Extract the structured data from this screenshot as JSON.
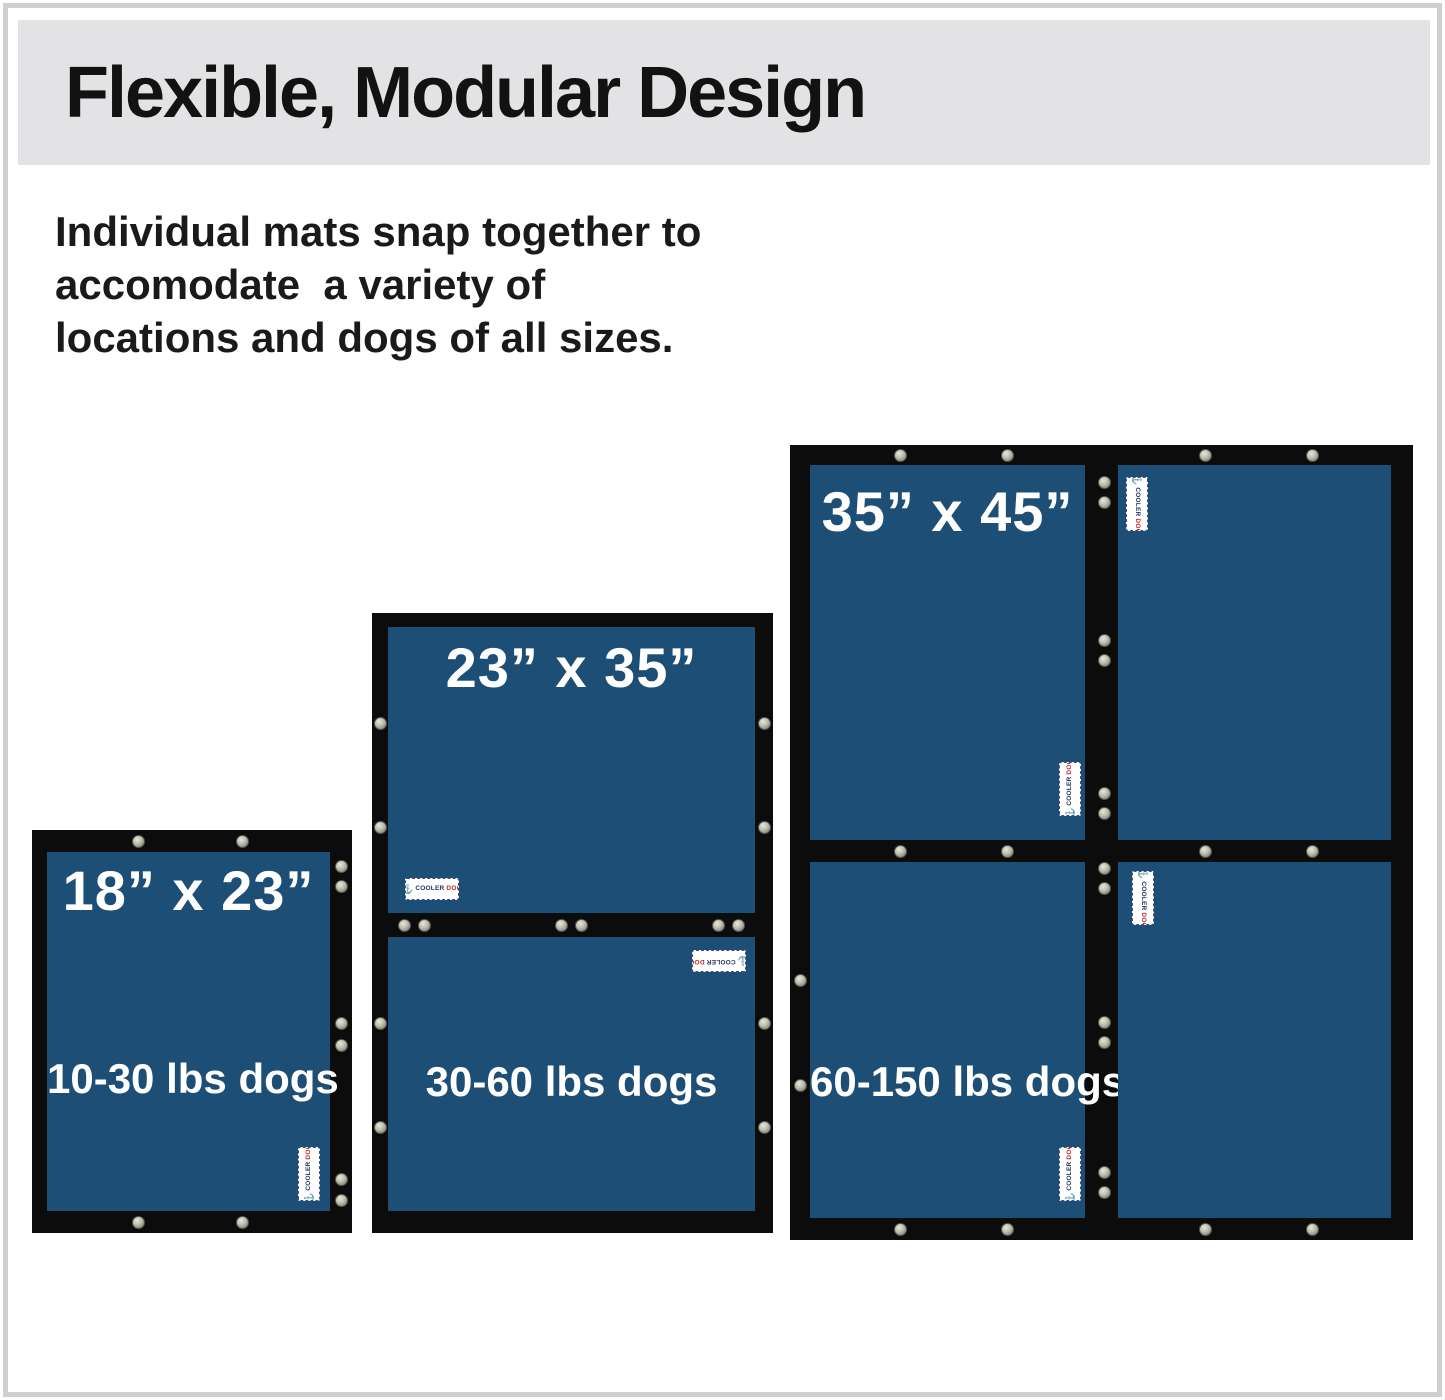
{
  "header": {
    "title": "Flexible, Modular Design"
  },
  "description": {
    "line1": "Individual mats snap together to",
    "line2": "accomodate  a variety of",
    "line3": "locations and dogs of all sizes."
  },
  "mats": {
    "small": {
      "size": "18” x 23”",
      "weight": "10-30 lbs dogs"
    },
    "medium": {
      "size": "23” x 35”",
      "weight": "30-60 lbs dogs"
    },
    "large": {
      "size": "35” x 45”",
      "weight": "60-150 lbs dogs"
    }
  },
  "tag": {
    "brand_part1": "COOLER",
    "brand_part2": "DOG",
    "logo_icon": "anchor-logo-icon"
  },
  "colors": {
    "banner_gray": "#e3e3e5",
    "mat_blue": "#1d4e76",
    "mat_border_black": "#0c0c0c",
    "text_black": "#1a1a1a",
    "text_white": "#ffffff",
    "snap_silver": "#bcbcae",
    "tag_navy": "#23355e",
    "tag_red": "#bb2a2a",
    "frame_gray": "#cfcfcf"
  }
}
